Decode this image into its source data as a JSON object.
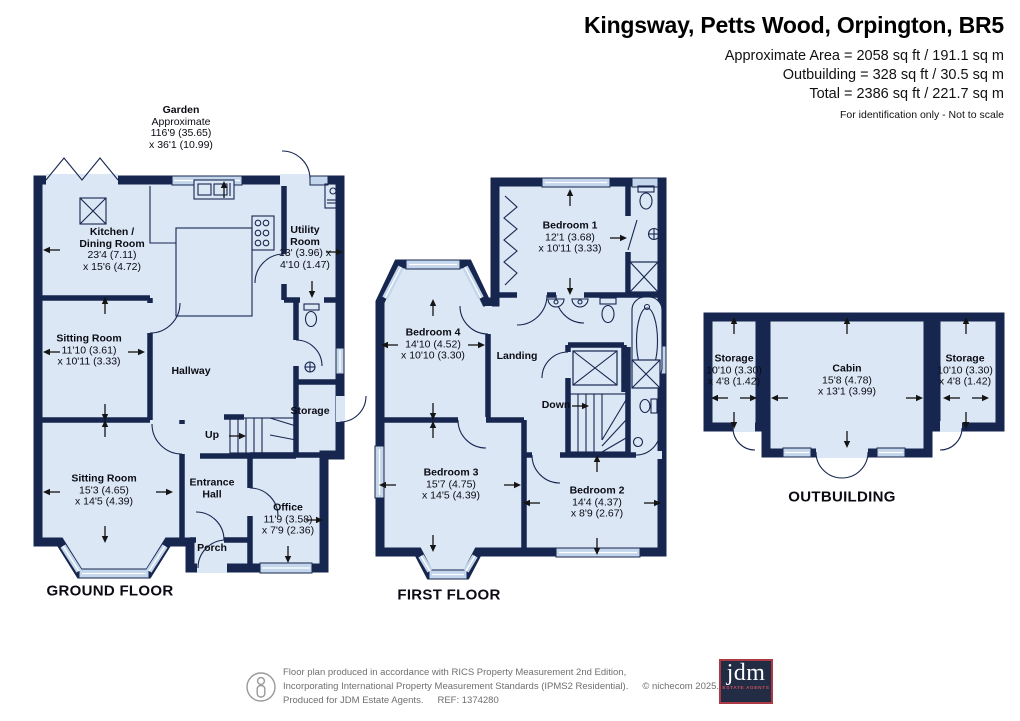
{
  "header": {
    "title": "Kingsway, Petts Wood, Orpington, BR5",
    "area_lines": [
      "Approximate Area = 2058 sq ft / 191.1 sq m",
      "Outbuilding = 328 sq ft / 30.5 sq m",
      "Total = 2386 sq ft / 221.7 sq m"
    ],
    "disclaimer": "For identification only - Not to scale"
  },
  "garden_label": {
    "name": "Garden",
    "l2": "Approximate",
    "l3": "116'9 (35.65)",
    "l4": "x 36'1 (10.99)"
  },
  "floor_titles": {
    "ground": "GROUND FLOOR",
    "first": "FIRST FLOOR",
    "outbuilding": "OUTBUILDING"
  },
  "rooms": {
    "gf_kitchen": {
      "l1": "Kitchen /",
      "l2": "Dining Room",
      "l3": "23'4 (7.11)",
      "l4": "x 15'6 (4.72)"
    },
    "gf_utility": {
      "l1": "Utility",
      "l2": "Room",
      "l3": "13' (3.96) x",
      "l4": "4'10 (1.47)"
    },
    "gf_sitting1": {
      "l1": "Sitting Room",
      "l3": "11'10 (3.61)",
      "l4": "x 10'11 (3.33)"
    },
    "gf_hallway": {
      "l1": "Hallway"
    },
    "gf_storage": {
      "l1": "Storage"
    },
    "gf_up": {
      "l1": "Up"
    },
    "gf_sitting2": {
      "l1": "Sitting Room",
      "l3": "15'3 (4.65)",
      "l4": "x 14'5 (4.39)"
    },
    "gf_entrance": {
      "l1": "Entrance",
      "l2": "Hall"
    },
    "gf_office": {
      "l1": "Office",
      "l3": "11'9 (3.58)",
      "l4": "x 7'9 (2.36)"
    },
    "gf_porch": {
      "l1": "Porch"
    },
    "ff_bed1": {
      "l1": "Bedroom 1",
      "l3": "12'1 (3.68)",
      "l4": "x 10'11 (3.33)"
    },
    "ff_bed4": {
      "l1": "Bedroom 4",
      "l3": "14'10 (4.52)",
      "l4": "x 10'10 (3.30)"
    },
    "ff_landing": {
      "l1": "Landing"
    },
    "ff_down": {
      "l1": "Down"
    },
    "ff_bed3": {
      "l1": "Bedroom 3",
      "l3": "15'7 (4.75)",
      "l4": "x 14'5 (4.39)"
    },
    "ff_bed2": {
      "l1": "Bedroom 2",
      "l3": "14'4 (4.37)",
      "l4": "x 8'9 (2.67)"
    },
    "ob_storage_l": {
      "l1": "Storage",
      "l3": "10'10 (3.30)",
      "l4": "x 4'8 (1.42)"
    },
    "ob_cabin": {
      "l1": "Cabin",
      "l3": "15'8 (4.78)",
      "l4": "x 13'1 (3.99)"
    },
    "ob_storage_r": {
      "l1": "Storage",
      "l3": "10'10 (3.30)",
      "l4": "x 4'8 (1.42)"
    }
  },
  "footer": {
    "line1": "Floor plan produced in accordance with RICS Property Measurement 2nd Edition,",
    "line2": "Incorporating International Property Measurement Standards (IPMS2 Residential).",
    "copyright": "© nichecom 2025.",
    "line3": "Produced for JDM Estate Agents.",
    "ref": "REF: 1374280"
  },
  "logo": {
    "name": "jdm",
    "tagline": "ESTATE AGENTS"
  },
  "colors": {
    "wall": "#17264f",
    "room_fill": "#dbe7f5",
    "glass": "#c3d6eb",
    "logo_navy": "#232c45",
    "logo_red": "#ab3a44"
  }
}
